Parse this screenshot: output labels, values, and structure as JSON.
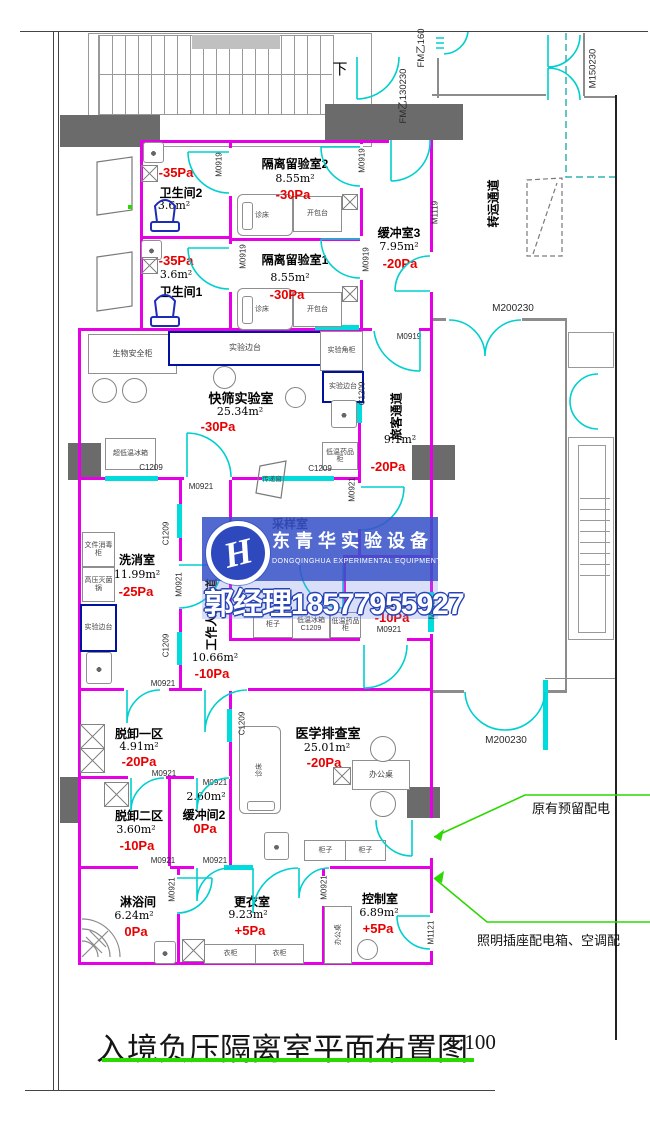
{
  "sheet": {
    "title": "入境负压隔离室平面布置图",
    "scale": "1:100",
    "down_label": "下"
  },
  "watermark": {
    "logo_letter": "H",
    "brand": "东青华实验设备",
    "brand_en": "DONGQINGHUA EXPERIMENTAL EQUIPMENT",
    "phone": "郭经理18577955927"
  },
  "rooms": {
    "geli2": {
      "name": "隔离留验室2",
      "area": "8.55m²",
      "pa": "-30Pa"
    },
    "geli1": {
      "name": "隔离留验室1",
      "area": "8.55m²",
      "pa": "-30Pa"
    },
    "wsj2": {
      "name": "卫生间2",
      "area": "3.6m²",
      "pa": "-35Pa"
    },
    "wsj1": {
      "name": "卫生间1",
      "area": "3.6m²",
      "pa": "-35Pa"
    },
    "hc3": {
      "name": "缓冲室3",
      "area": "7.95m²",
      "pa": "-20Pa"
    },
    "ks": {
      "name": "快筛实验室",
      "area": "25.34m²",
      "pa": "-30Pa"
    },
    "lk": {
      "name": "旅客通道",
      "area": "9.1m²",
      "pa": "-20Pa"
    },
    "xx": {
      "name": "洗消室",
      "area": "11.99m²",
      "pa": "-25Pa"
    },
    "cy": {
      "name": "采样室"
    },
    "gzry": {
      "name": "工作人员通道",
      "area": "10.66m²",
      "pa": "-10Pa"
    },
    "hc1": {
      "area": "3.41m²",
      "pa": "-10Pa"
    },
    "tx1": {
      "name": "脱卸一区",
      "area": "4.91m²",
      "pa": "-20Pa"
    },
    "tx2": {
      "name": "脱卸二区",
      "area": "3.60m²",
      "pa": "-10Pa"
    },
    "hc2": {
      "name": "缓冲间2",
      "area": "2.60m²",
      "pa": "0Pa"
    },
    "yx": {
      "name": "医学排查室",
      "area": "25.01m²",
      "pa": "-20Pa"
    },
    "ly": {
      "name": "淋浴间",
      "area": "6.24m²",
      "pa": "0Pa"
    },
    "gy": {
      "name": "更衣室",
      "area": "9.23m²",
      "pa": "+5Pa"
    },
    "kz": {
      "name": "控制室",
      "area": "6.89m²",
      "pa": "+5Pa"
    },
    "zy": {
      "name": "转运通道"
    }
  },
  "codes": {
    "m0919": "M0919",
    "m0921": "M0921",
    "c1209": "C1209",
    "m1119": "M1119",
    "m1121": "M1121",
    "m150230": "M150230",
    "m200230": "M200230",
    "fm130": "FM乙130230",
    "fm160": "FM乙160"
  },
  "furniture": {
    "zc": "诊床",
    "kbt": "开包台",
    "bench": "实验边台",
    "corner": "实验角柜",
    "bsc": "生物安全柜",
    "ulf": "超低温冰箱",
    "med": "低温药品柜",
    "fridge": "低温冰箱",
    "pass": "传递窗",
    "doc": "文件消毒柜",
    "auto": "高压灭菌锅",
    "cab": "柜子",
    "desk": "办公桌",
    "ward": "衣柜"
  },
  "notes": {
    "a1": "原有预留配电",
    "a2": "照明插座配电箱、空调配"
  },
  "colors": {
    "wall": "#e600e6",
    "door": "#00cfcf",
    "pressure": "#e60000",
    "leader": "#2bd800",
    "watermark": "#3853c9"
  }
}
